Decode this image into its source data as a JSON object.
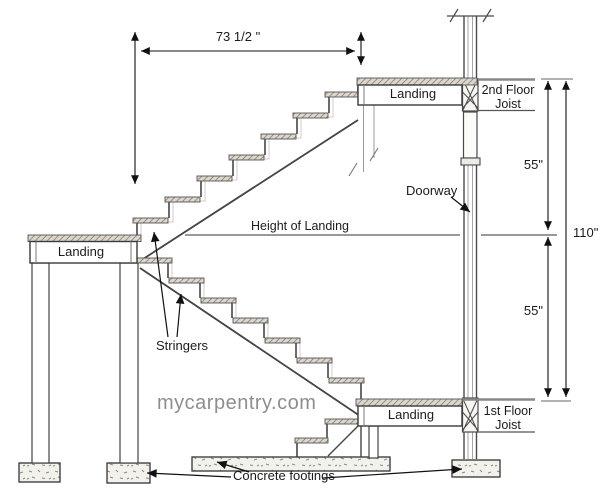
{
  "diagram": {
    "watermark": "mycarpentry.com",
    "dimensions": {
      "stair_run": "73 1/2 \"",
      "upper_flight_height": "55\"",
      "lower_flight_height": "55\"",
      "total_height": "110\"",
      "height_of_landing_label": "Height of Landing"
    },
    "labels": {
      "top_landing": "Landing",
      "middle_landing": "Landing",
      "bottom_landing": "Landing",
      "second_floor_joist": "2nd Floor Joist",
      "first_floor_joist": "1st Floor Joist",
      "doorway": "Doorway",
      "stringers": "Stringers",
      "concrete_footings": "Concrete footings"
    },
    "colors": {
      "ink": "#3a3a3a",
      "dimension_ink": "#111111",
      "watermark_gray": "#8e8e8e",
      "tread_fill": "#dcd8cf",
      "tread_hatch": "#9a9284",
      "concrete_fill": "#f2f1ec",
      "concrete_speckle": "#8a8a82",
      "background": "#ffffff"
    }
  }
}
